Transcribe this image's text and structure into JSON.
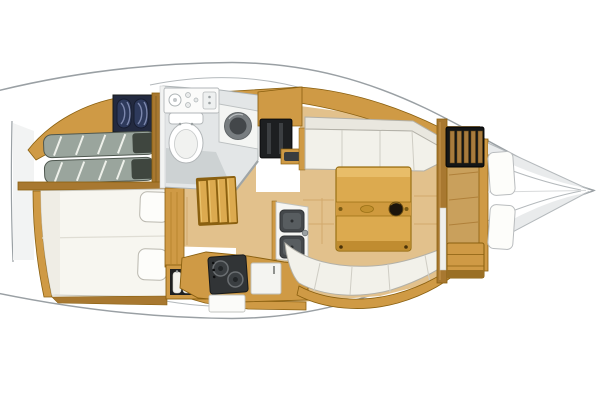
{
  "legend": {
    "boat": "Sailboat interior layout floor plan, bow pointing right",
    "stern": "Stern transom",
    "aft_cabin_port": "Aft cabin (top) with double berth, striped mattresses and navy cushion stowage",
    "aft_cabin_starboard": "Aft cabin (bottom) with white double berth and two pillows",
    "hanging_locker": "Hanging locker with shirts on hangers",
    "head": "Head compartment with toilet, vanity sink and round washbasin",
    "locker_shelves": "Cabinet with dark slatted locker front",
    "companionway": "Companionway steps",
    "galley": "Galley with two-burner stove, refrigerator front and twin sinks",
    "salon": "Saloon with facing settees and wooden folding table with cupholder",
    "table": "Folding saloon table",
    "forward_cabin": "Forward cabin with slatted locker, mirror and chest of drawers",
    "v_berth": "V-berth with two cushions tapering to the bow",
    "bow": "Bow point"
  },
  "palette": {
    "white": "#ffffff",
    "hull_outline": "#9aa0a4",
    "deck_line": "#b4b9bc",
    "soft_line": "#d8dadb",
    "wood": "#cf9a45",
    "wood_light": "#e3b868",
    "wood_dark": "#a87830",
    "wood_edge": "#8a6010",
    "floor": "#e2c18c",
    "floor_line": "#d2a96c",
    "table_wood": "#dcaa4f",
    "upholstery": "#f2f1ea",
    "upholstery_dim": "#e9e7df",
    "upholstery_line": "#b3b1a8",
    "bedding": "#f7f6f0",
    "pillow": "#fdfdfa",
    "mattress_gray": "#9aa59d",
    "mattress_dark": "#4e574f",
    "navy": "#2e3a5c",
    "navy_dark": "#232a40",
    "appliance_dark": "#313436",
    "sink_dark": "#44484b",
    "head_wall": "#e3e6e7",
    "head_floor": "#cdd2d3",
    "fixture_white": "#fbfbfa",
    "fixture_line": "#b2b6b8",
    "locker_dark": "#1d1f21",
    "shadow": "#e9ebec"
  }
}
